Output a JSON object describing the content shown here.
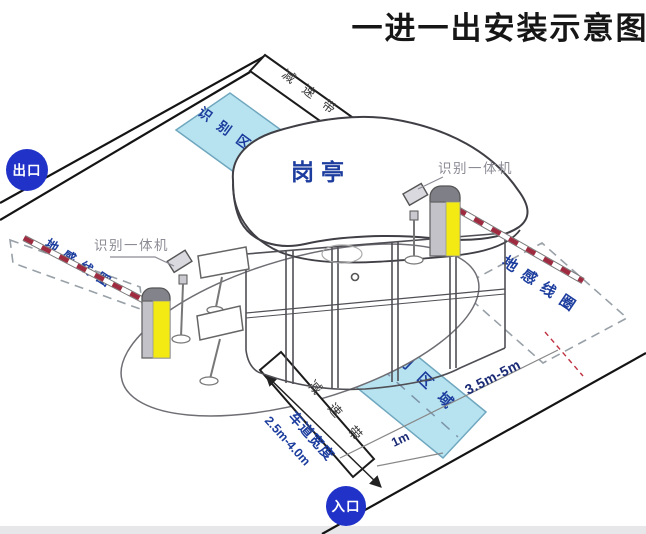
{
  "title": "一进一出安装示意图",
  "badges": {
    "exit": "出口",
    "entrance": "入口"
  },
  "booth_label": "岗亭",
  "areas": {
    "recognition_top": "识别区域",
    "recognition_bottom": "识别区域",
    "ground_loop_left": "地感线圈",
    "ground_loop_right": "地感线圈"
  },
  "bands": {
    "speed_bump_top": "减速带",
    "speed_bump_bottom": "减速带"
  },
  "devices": {
    "reader_left": "识别一体机",
    "reader_right": "识别一体机"
  },
  "dimensions": {
    "lane_width_label": "车道宽度",
    "lane_width_value": "2.5m-4.0m",
    "loop_distance": "3.5m-5m",
    "area_offset": "1m"
  },
  "colors": {
    "area_fill": "#b7e3f0",
    "area_border": "#6fa7bf",
    "label_blue": "#1c3d9e",
    "badge_blue": "#2032c8",
    "machine_yellow": "#f2ea12",
    "machine_gray": "#83838c",
    "arm_red": "#9e2b3f",
    "dash_gray": "#98a0a8",
    "title_color": "#161616"
  }
}
